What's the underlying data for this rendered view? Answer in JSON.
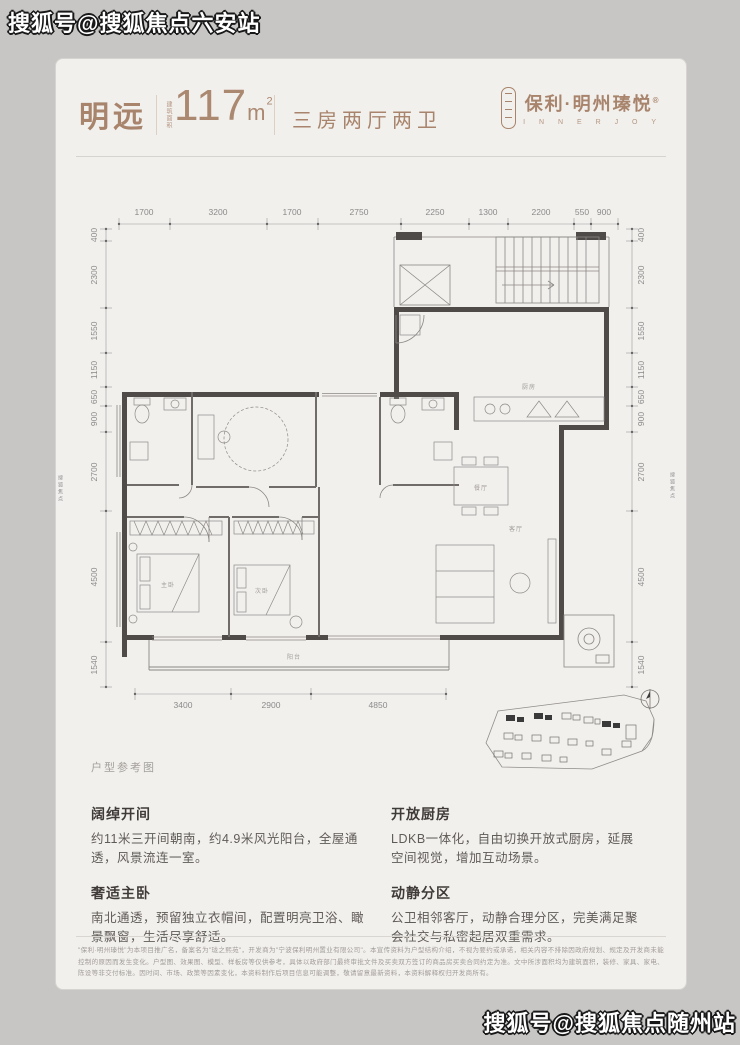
{
  "watermarks": {
    "top": "搜狐号@搜狐焦点六安站",
    "bottom": "搜狐号@搜狐焦点随州站",
    "edge": "搜狐焦点"
  },
  "header": {
    "unit_name": "明远",
    "area_prefix": "建筑面积",
    "area_value": "117",
    "area_unit_m": "m",
    "area_unit_sup": "2",
    "layout": "三房两厅两卫",
    "brand": "保利·明州瑧悦",
    "brand_reg": "®",
    "brand_en": "I N N E R J O Y"
  },
  "plan": {
    "caption": "户型参考图",
    "dims_top": [
      "1700",
      "3200",
      "1700",
      "2750",
      "2250",
      "1300",
      "2200",
      "550",
      "900"
    ],
    "dims_side": [
      "400",
      "2300",
      "1550",
      "1150",
      "650",
      "900",
      "2700",
      "4500",
      "1540"
    ],
    "dims_bottom": [
      "3400",
      "2900",
      "4850"
    ],
    "rooms": {
      "master": "主卧",
      "bedroom2": "次卧",
      "living": "客厅",
      "dining": "餐厅",
      "kitchen": "厨房",
      "balcony": "阳台"
    }
  },
  "features": [
    {
      "title": "阔绰开间",
      "body": "约11米三开间朝南，约4.9米风光阳台，全屋通透，风景流连一室。"
    },
    {
      "title": "奢适主卧",
      "body": "南北通透，预留独立衣帽间，配置明亮卫浴、瞰景飘窗，生活尽享舒适。"
    },
    {
      "title": "开放厨房",
      "body": "LDKB一体化，自由切换开放式厨房，延展空间视觉，增加互动场景。"
    },
    {
      "title": "动静分区",
      "body": "公卫相邻客厅，动静合理分区，完美满足聚会社交与私密起居双重需求。"
    }
  ],
  "disclaimer": "\"保利·明州瑧悦\"为本项目推广名，备案名为\"珑之熙苑\"，开发商为\"宁波保利明州置业有限公司\"。本宣传资料为户型结构介绍，不视为要约或承诺，相关内容不排除因政府规划、规定及开发商未能控制的原因而发生变化。户型图、效果图、模型、样板房等仅供参考，具体以政府部门最终审批文件及买卖双方签订的商品房买卖合同约定为准。文中所涉面积均为建筑面积，装修、家具、家电、陈设等非交付标准。因时间、市场、政策等因素变化，本资料制作后项目信息可能调整，敬请留意最新资料，本资料解释权归开发商所有。"
}
